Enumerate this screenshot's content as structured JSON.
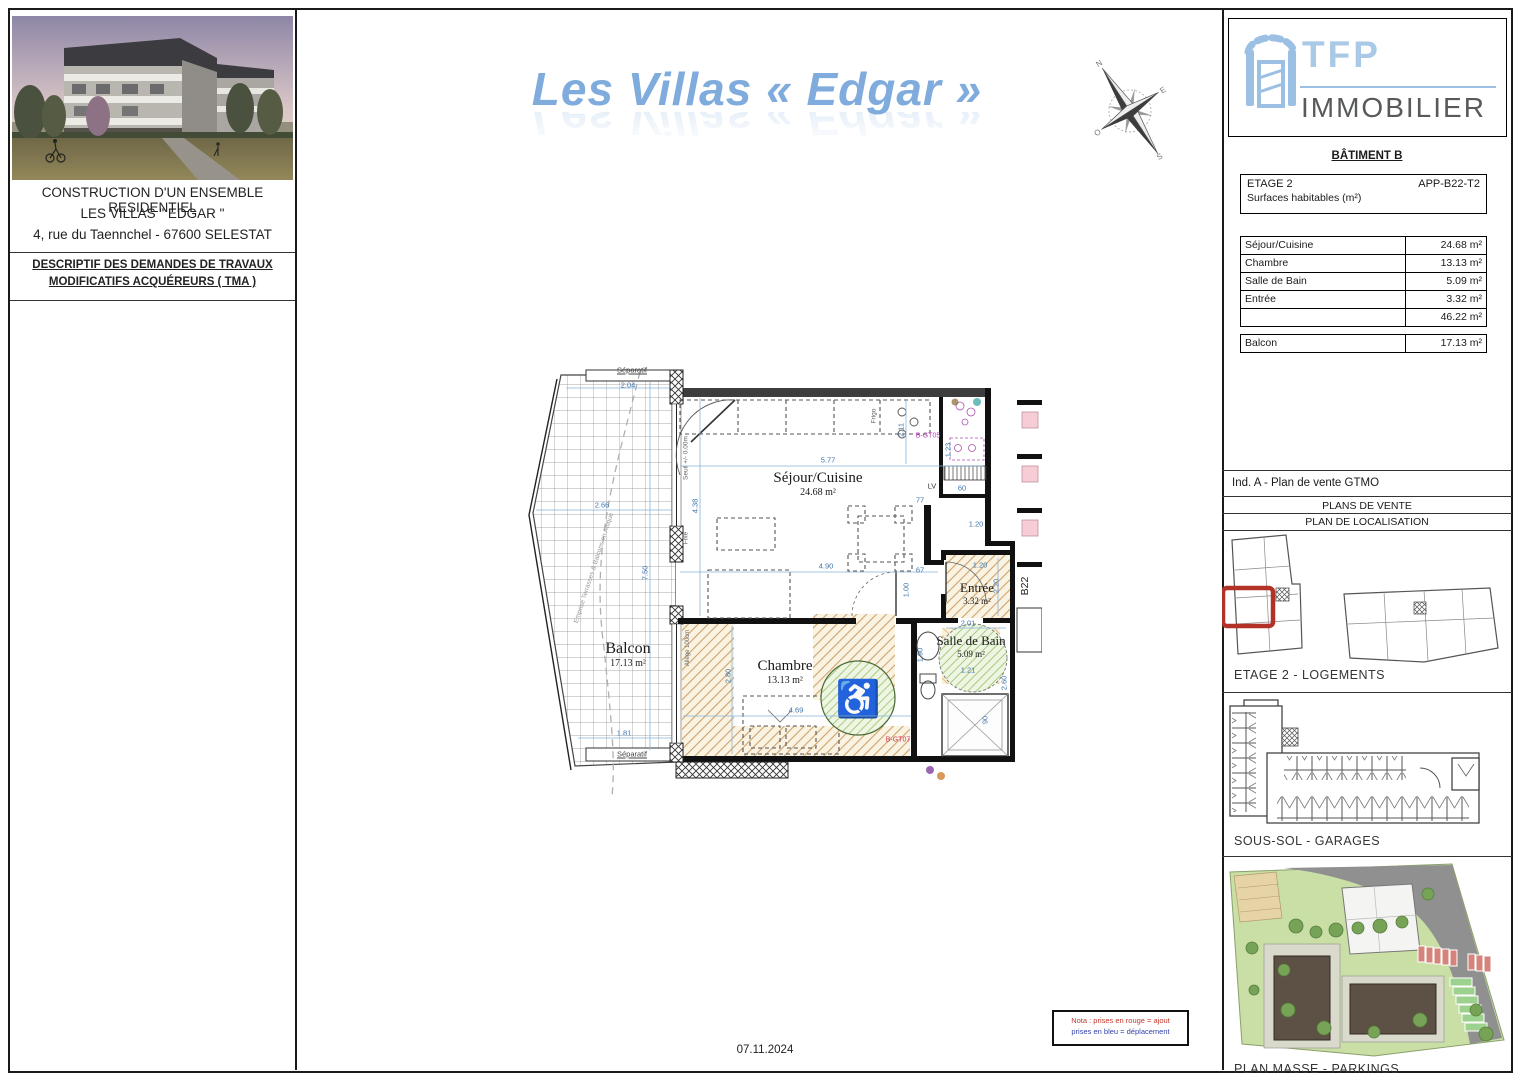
{
  "title": "Les Villas « Edgar »",
  "date": "07.11.2024",
  "left_panel": {
    "line1": "CONSTRUCTION D'UN ENSEMBLE RESIDENTIEL",
    "line2": "LES VILLAS \" EDGAR \"",
    "line3": "4, rue du Taennchel - 67600 SELESTAT",
    "desc1": "DESCRIPTIF DES DEMANDES DE TRAVAUX",
    "desc2": "MODIFICATIFS ACQUÉREURS ( TMA )"
  },
  "logo": {
    "brand": "TFP",
    "word": "IMMOBILIER"
  },
  "right_panel": {
    "batiment": "BÂTIMENT B",
    "etage": "ETAGE 2",
    "ref": "APP-B22-T2",
    "surfaces_title": "Surfaces habitables (m²)",
    "rows": [
      {
        "label": "Séjour/Cuisine",
        "value": "24.68 m²"
      },
      {
        "label": "Chambre",
        "value": "13.13 m²"
      },
      {
        "label": "Salle de Bain",
        "value": "5.09 m²"
      },
      {
        "label": "Entrée",
        "value": "3.32 m²"
      },
      {
        "label": "",
        "value": "46.22 m²"
      }
    ],
    "balcon": {
      "label": "Balcon",
      "value": "17.13 m²"
    },
    "ind": "Ind. A - Plan de vente GTMO",
    "plans_de_vente": "PLANS DE VENTE",
    "plan_localisation": "PLAN DE LOCALISATION",
    "caption_etage2": "ETAGE 2 - LOGEMENTS",
    "caption_soussol": "SOUS-SOL - GARAGES",
    "caption_masse": "PLAN MASSE - PARKINGS"
  },
  "plan": {
    "rooms": {
      "sejour": {
        "name": "Séjour/Cuisine",
        "area": "24.68 m²"
      },
      "chambre": {
        "name": "Chambre",
        "area": "13.13 m²"
      },
      "balcon": {
        "name": "Balcon",
        "area": "17.13 m²"
      },
      "entree": {
        "name": "Entrée",
        "area": "3.32 m²"
      },
      "sdb": {
        "name": "Salle de Bain",
        "area": "5.09 m²"
      }
    },
    "dims": {
      "balcon_w": "2.04",
      "balcon_w2": "2.66",
      "balcon_h": "7.50",
      "balcon_w3": "1.81",
      "sejour_w": "5.77",
      "sejour_h": "4.38",
      "sejour_w2": "4.90",
      "kitchen_h": "2.11",
      "kitchen_h2": "1.23",
      "kitchen_w": "60",
      "vest_w": "77",
      "vest_w2": "67",
      "entree_w": "1.20",
      "entree_w2": "1.20",
      "entree_h": "2.20",
      "entree_h2": "1.00",
      "sdb_w": "2.01",
      "sdb_h": "1.90",
      "sdb_w2": "1.21",
      "sdb_h2": "2.60",
      "sdb_w3": "90",
      "chambre_w": "4.69",
      "chambre_h": "2.80"
    },
    "ann": {
      "separatif_top": "Séparatif",
      "separatif_bottom": "Séparatif",
      "emprise": "Emprise Terrasses & Balcons en Attique",
      "seuil": "Seuil +/- 0.00m",
      "fixe": "Fixe",
      "allege": "Allège 100cm",
      "frigo": "Frigo",
      "lv": "LV",
      "bgt05": "B-GT05",
      "bgt07": "B-GT07",
      "b22": "B22"
    }
  },
  "note": {
    "l1": "Nota : prises en rouge = ajout",
    "l2": "prises en bleu = déplacement"
  },
  "compass": {
    "n": "N",
    "e": "E",
    "s": "S",
    "o": "O"
  }
}
